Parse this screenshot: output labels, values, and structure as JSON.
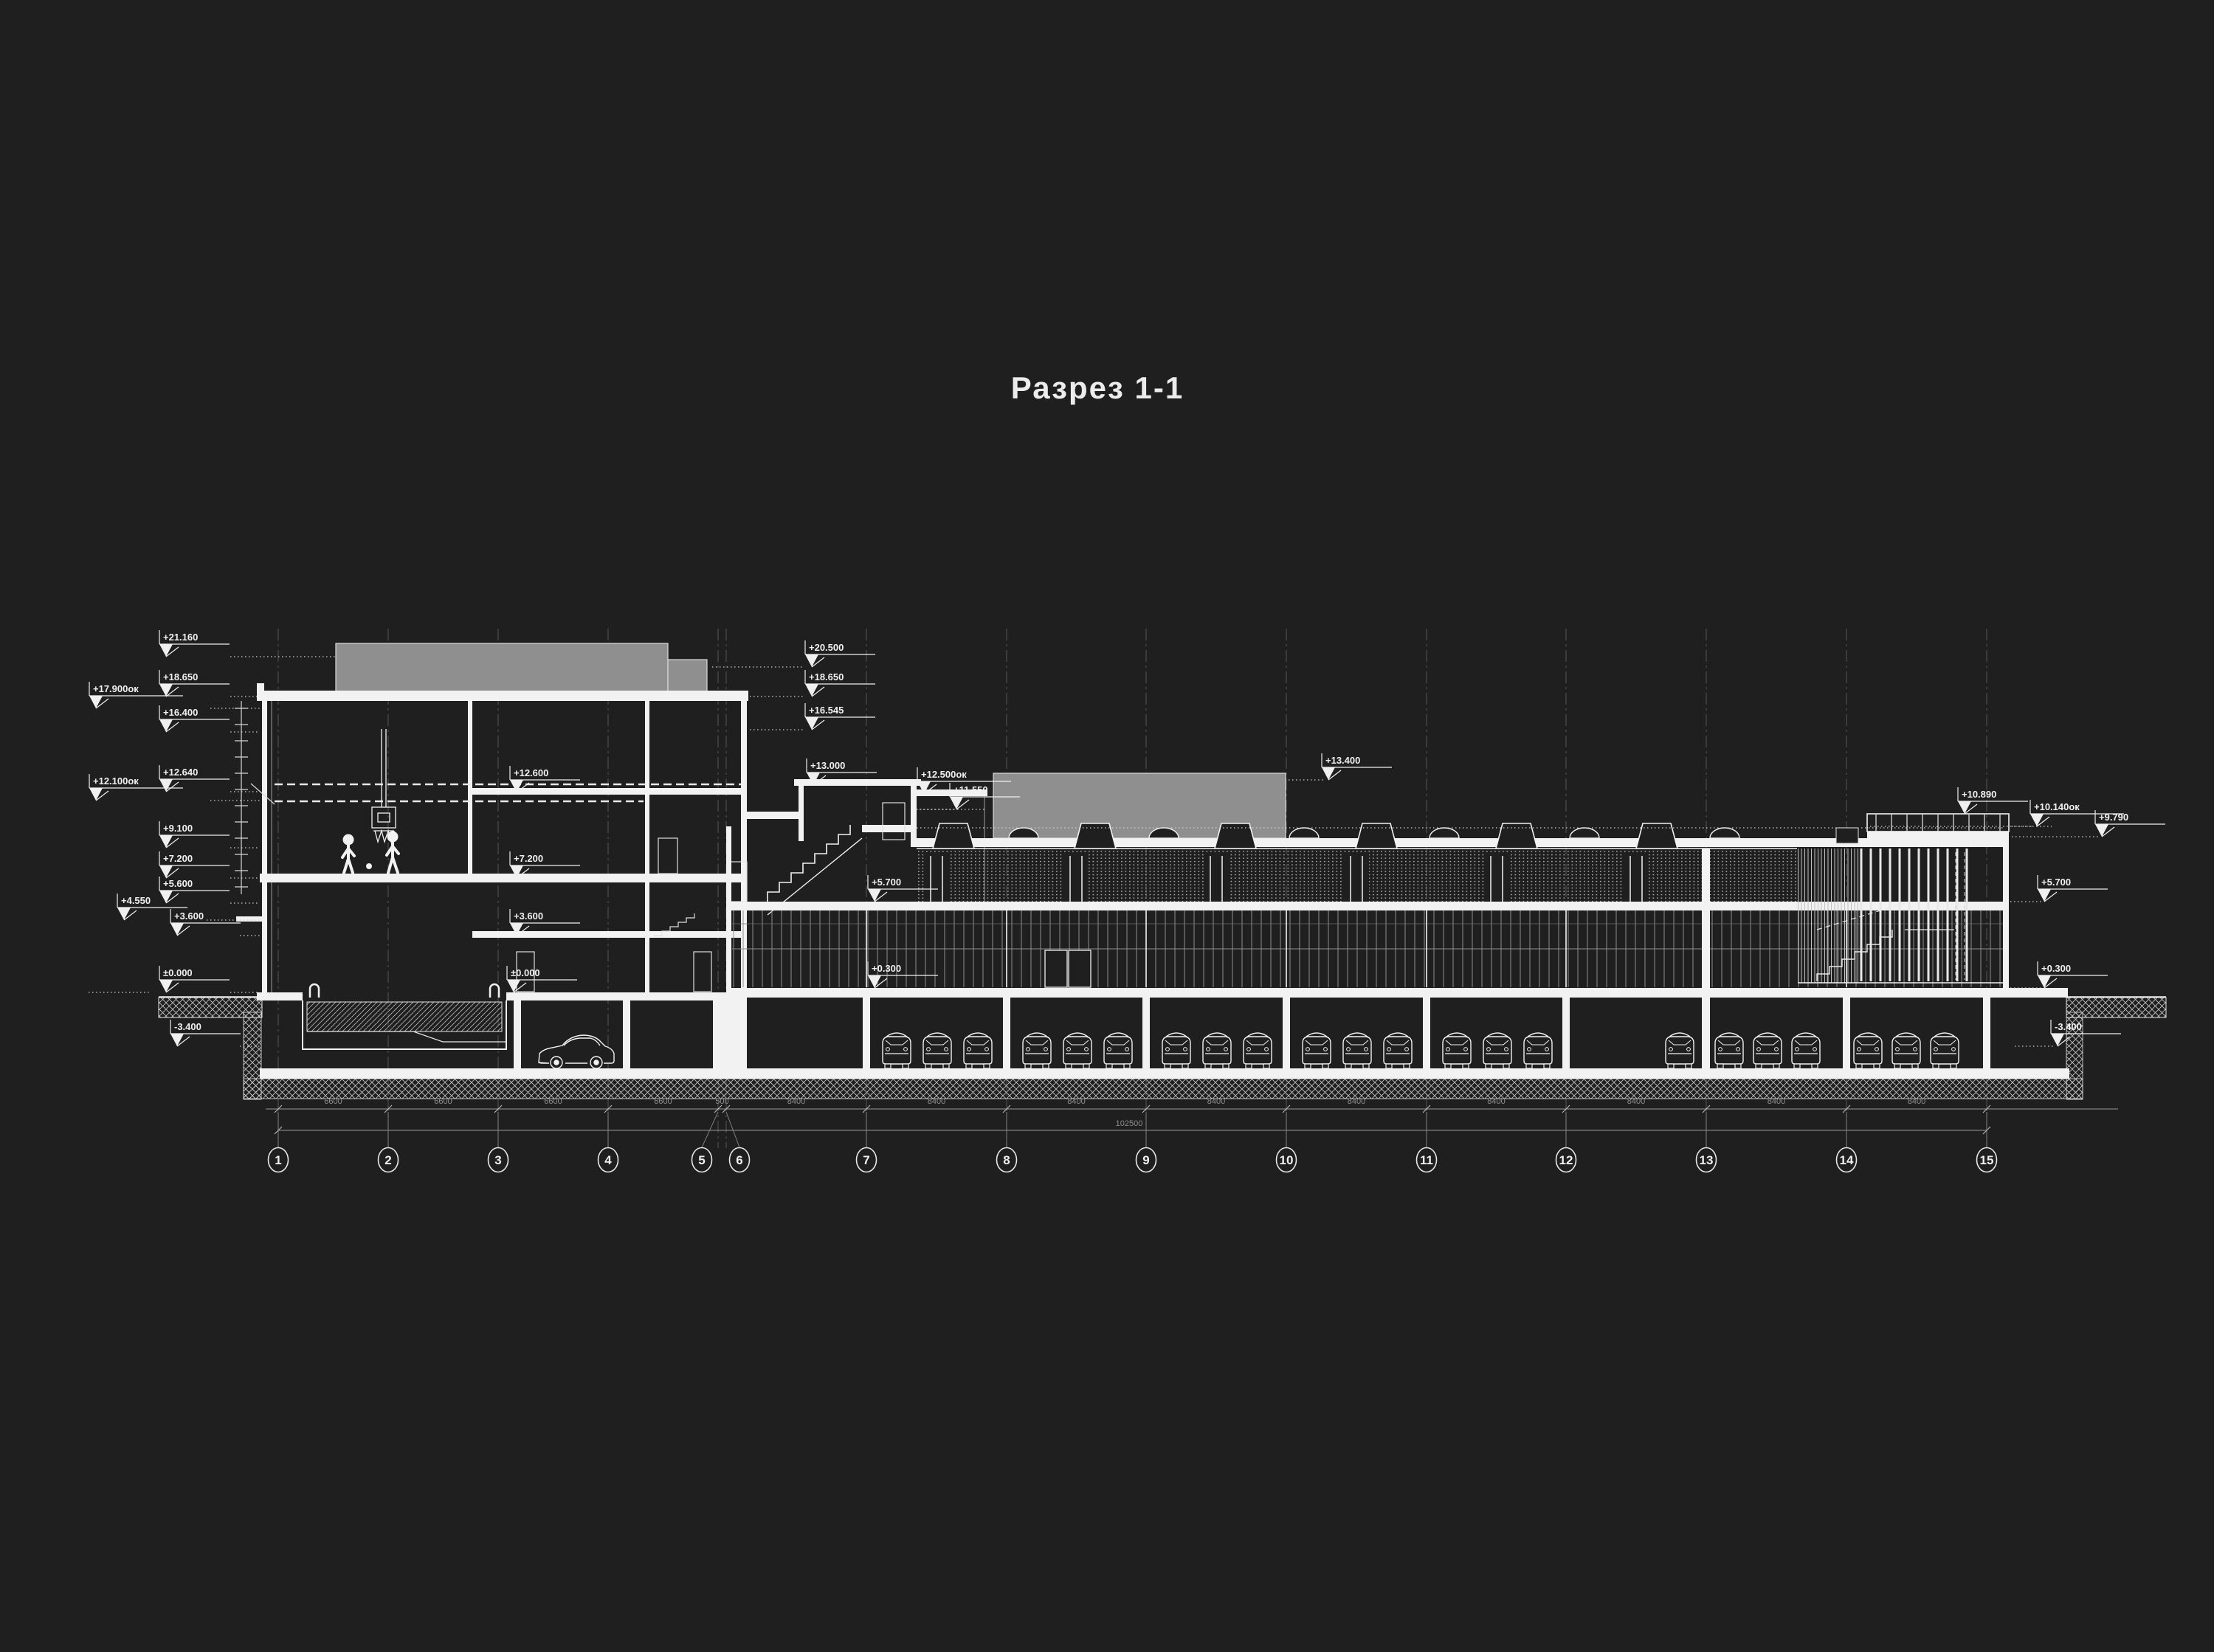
{
  "title": "Разрез 1-1",
  "levels": {
    "left": [
      "+21.160",
      "+18.650",
      "+17.900ок",
      "+16.400",
      "+12.640",
      "+12.100ок",
      "+9.100",
      "+7.200",
      "+5.600",
      "+4.550",
      "+3.600",
      "±0.000",
      "-3.400"
    ],
    "middle": [
      "+20.500",
      "+18.650",
      "+16.545",
      "+13.000",
      "+12.500ок",
      "+11.550",
      "+13.400"
    ],
    "right": [
      "+10.890",
      "+10.140ок",
      "+9.790",
      "+5.700",
      "+0.300",
      "-3.400"
    ],
    "internal_left": [
      "+12.600",
      "+7.200",
      "+3.600",
      "±0.000"
    ],
    "internal_right": [
      "+5.700",
      "+0.300"
    ]
  },
  "grid": {
    "bubbles": [
      "1",
      "2",
      "3",
      "4",
      "5",
      "6",
      "7",
      "8",
      "9",
      "10",
      "11",
      "12",
      "13",
      "14",
      "15"
    ],
    "dims": [
      "6600",
      "6600",
      "6600",
      "6600",
      "500",
      "8400",
      "8400",
      "8400",
      "8400",
      "8400",
      "8400",
      "8400",
      "8400",
      "8400"
    ],
    "total": "102500"
  },
  "colors": {
    "background": "#1f1f1f",
    "line": "#f2f2f2",
    "dim": "#8f8f8f",
    "roof_block": "#8f8f8f"
  }
}
